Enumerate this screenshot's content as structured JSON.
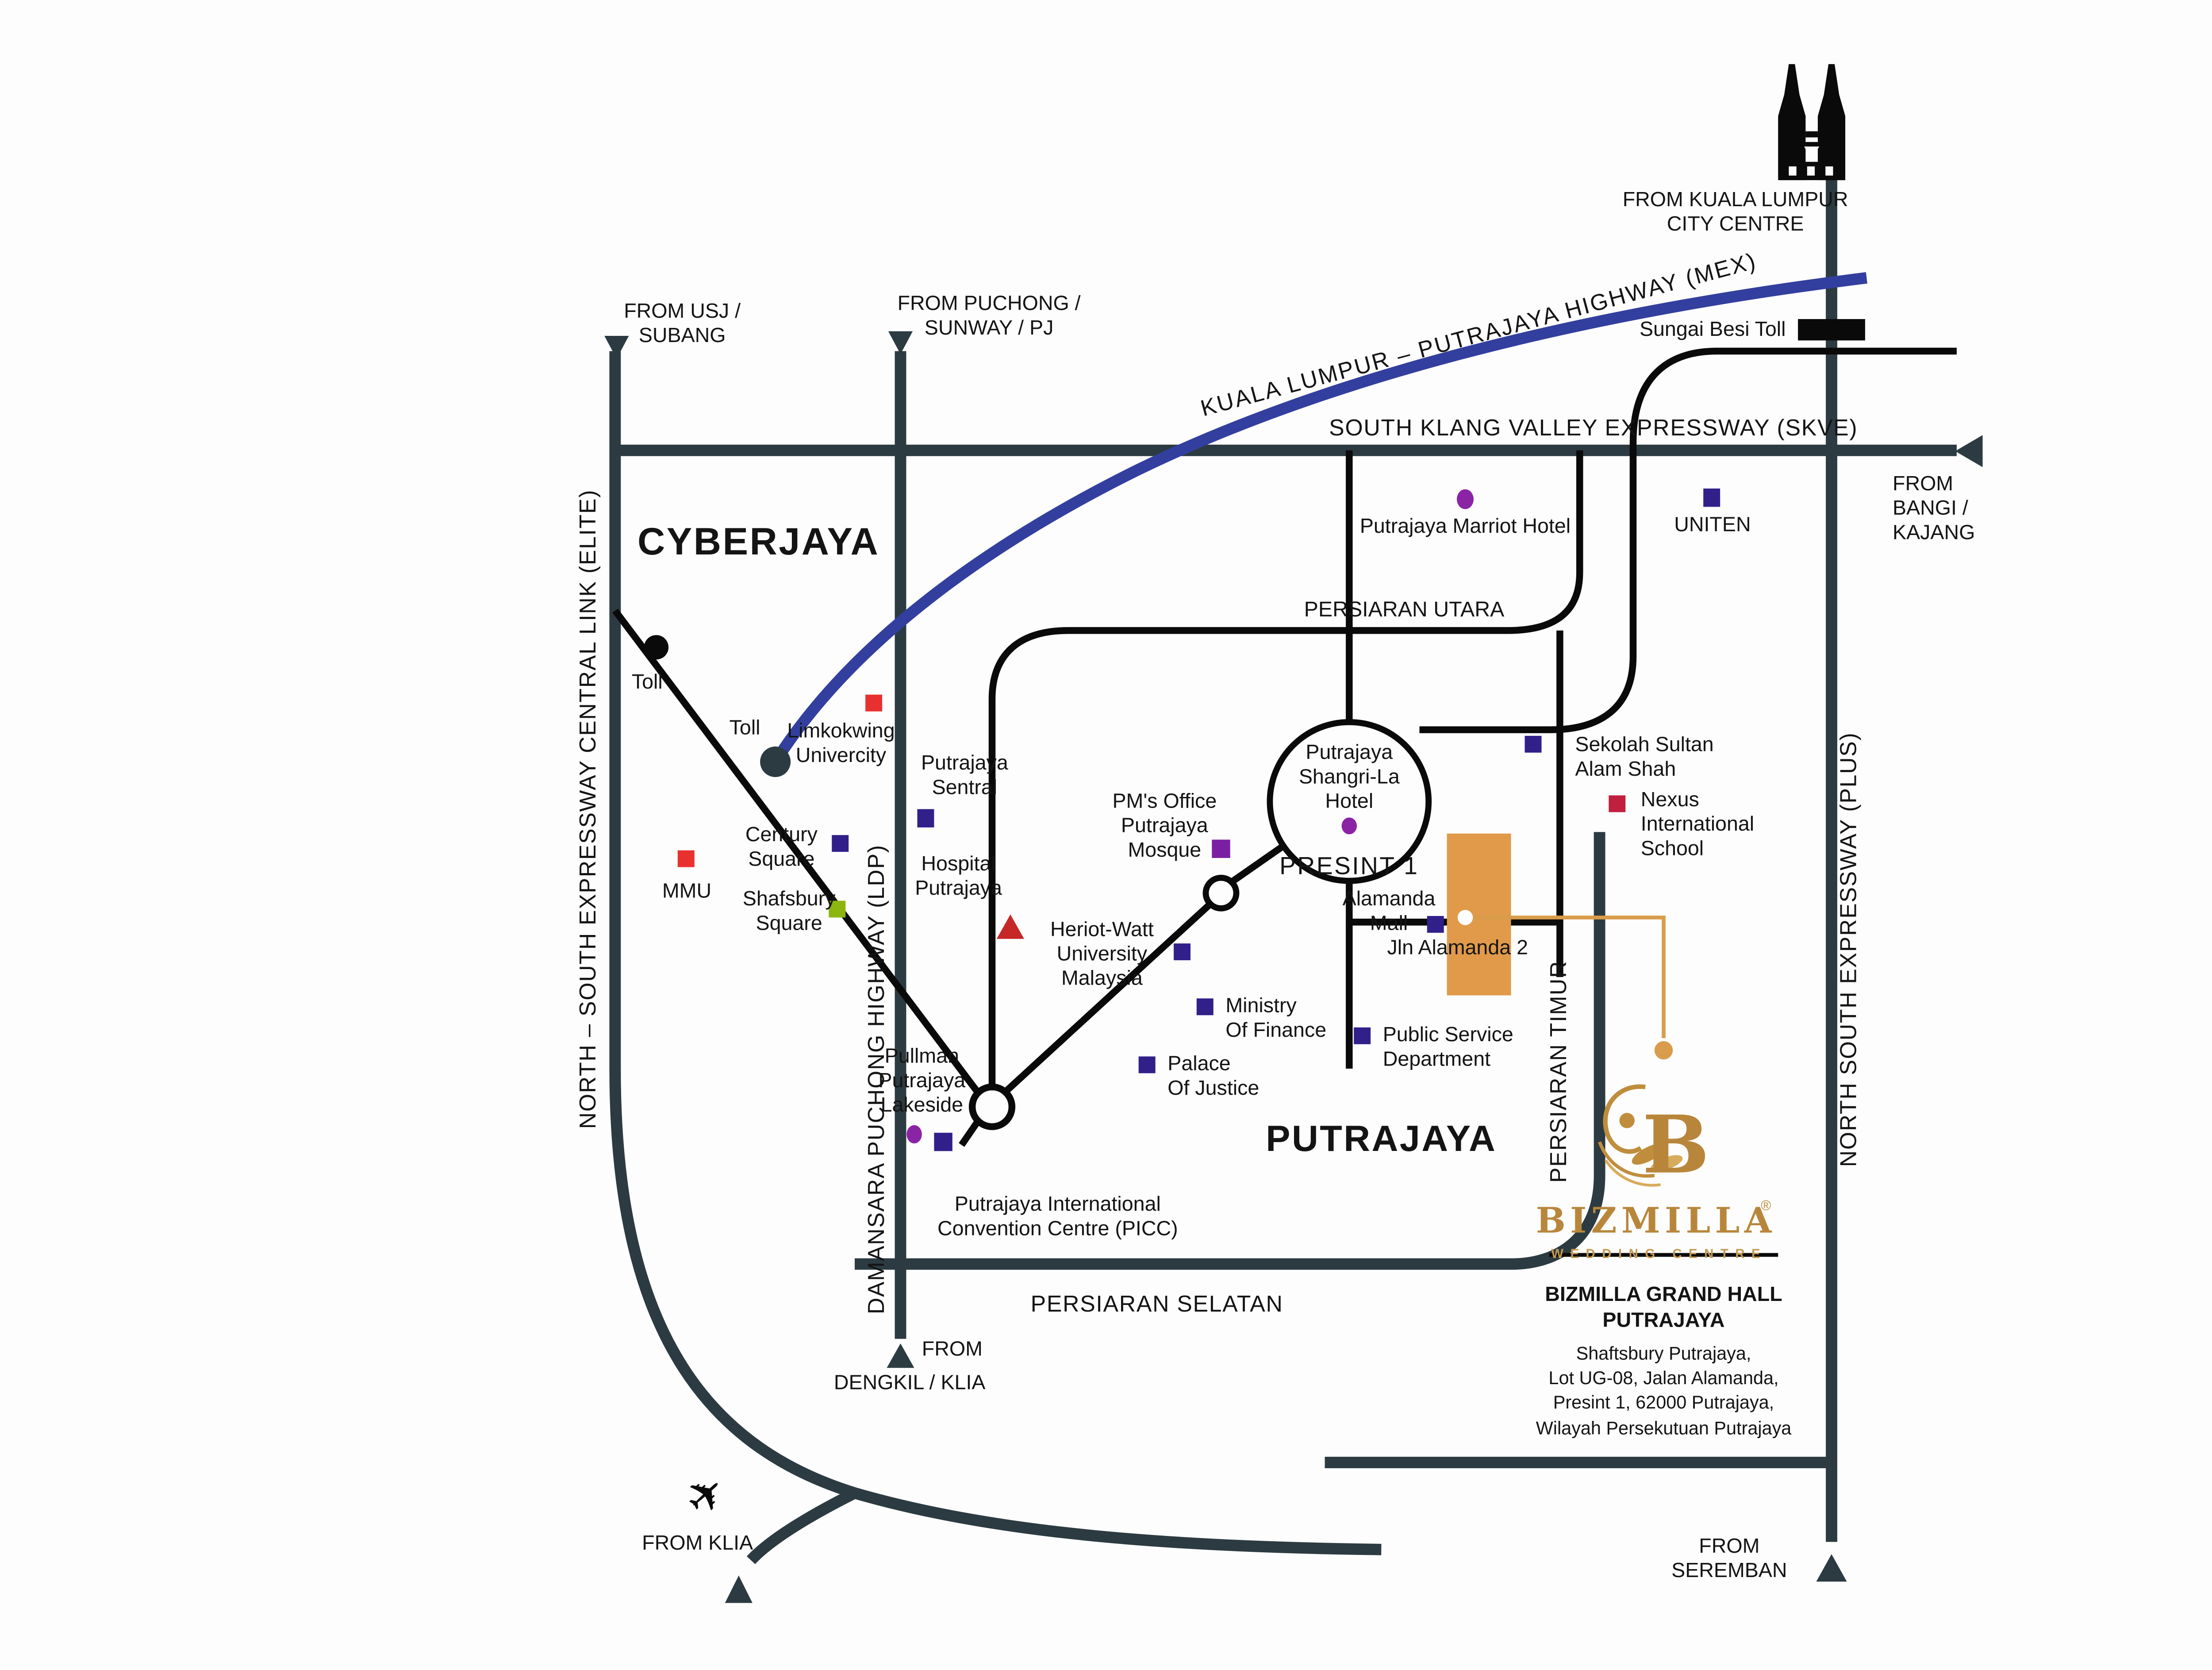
{
  "map": {
    "regions": {
      "cyberjaya": "CYBERJAYA",
      "putrajaya": "PUTRAJAYA",
      "presint_1": "PRESINT 1"
    },
    "highways": {
      "mex": "KUALA LUMPUR – PUTRAJAYA HIGHWAY (MEX)",
      "skve": "SOUTH KLANG VALLEY EXPRESSWAY (SKVE)",
      "elite": "NORTH – SOUTH EXPRESSWAY CENTRAL LINK (ELITE)",
      "ldp": "DAMANSARA PUCHONG HIGHWAY (LDP)",
      "plus": "NORTH SOUTH EXPRESSWAY (PLUS)",
      "utara": "PERSIARAN UTARA",
      "selatan": "PERSIARAN SELATAN",
      "timur": "PERSIARAN TIMUR",
      "jln_alamanda2": "Jln Alamanda 2"
    },
    "entry_points": {
      "from_usj": "FROM USJ /\nSUBANG",
      "from_puchong": "FROM PUCHONG /\nSUNWAY / PJ",
      "from_kl": "FROM KUALA LUMPUR\nCITY CENTRE",
      "from_bangi": "FROM\nBANGI /\nKAJANG",
      "from_dengkil_line1": "FROM",
      "from_dengkil_line2": "DENGKIL / KLIA",
      "from_klia": "FROM KLIA",
      "from_seremban": "FROM\nSEREMBAN"
    },
    "tolls": {
      "sungai_besi": "Sungai Besi Toll",
      "toll_elite": "Toll",
      "toll_mex": "Toll"
    },
    "places": {
      "marriot": "Putrajaya Marriot Hotel",
      "uniten": "UNITEN",
      "limkokwing": "Limkokwing\nUnivercity",
      "sentral": "Putrajaya\nSentral",
      "century": "Century\nSquare",
      "mmu": "MMU",
      "shafsbury": "Shafsbury\nSquare",
      "hospital": "Hospital\nPutrajaya",
      "pm_office": "PM's Office\nPutrajaya\nMosque",
      "shangrila": "Putrajaya\nShangri-La\nHotel",
      "sekolah": "Sekolah Sultan\nAlam Shah",
      "nexus": "Nexus\nInternational\nSchool",
      "heriot": "Heriot-Watt\nUniversity\nMalaysia",
      "ministry": "Ministry\nOf Finance",
      "psd": "Public Service\nDepartment",
      "alamanda": "Alamanda\nMall",
      "palace": "Palace\nOf Justice",
      "pullman": "Pullman\nPutrajaya\nLakeside",
      "picc": "Putrajaya International\nConvention Centre (PICC)"
    },
    "brand": {
      "name": "BIZMILLA",
      "reg": "®",
      "tagline": "WEDDING CENTRE",
      "hall": "BIZMILLA GRAND HALL\nPUTRAJAYA",
      "address": "Shaftsbury Putrajaya,\nLot UG-08, Jalan Alamanda,\nPresint 1, 62000 Putrajaya,\nWilayah Persekutuan Putrajaya"
    },
    "icons": {
      "airplane": "✈"
    },
    "colors": {
      "road_dark": "#2c3b41",
      "road_black": "#0a0a0a",
      "mex_blue": "#333f9e",
      "gold": "#c08d3c",
      "orange_building": "#e09a4a",
      "marker_indigo": "#31208a",
      "marker_purple": "#8b23a5",
      "marker_red": "#e8312f",
      "marker_crimson": "#c11f3e",
      "marker_green": "#8db510",
      "marker_violet": "#7b1fa2"
    }
  }
}
